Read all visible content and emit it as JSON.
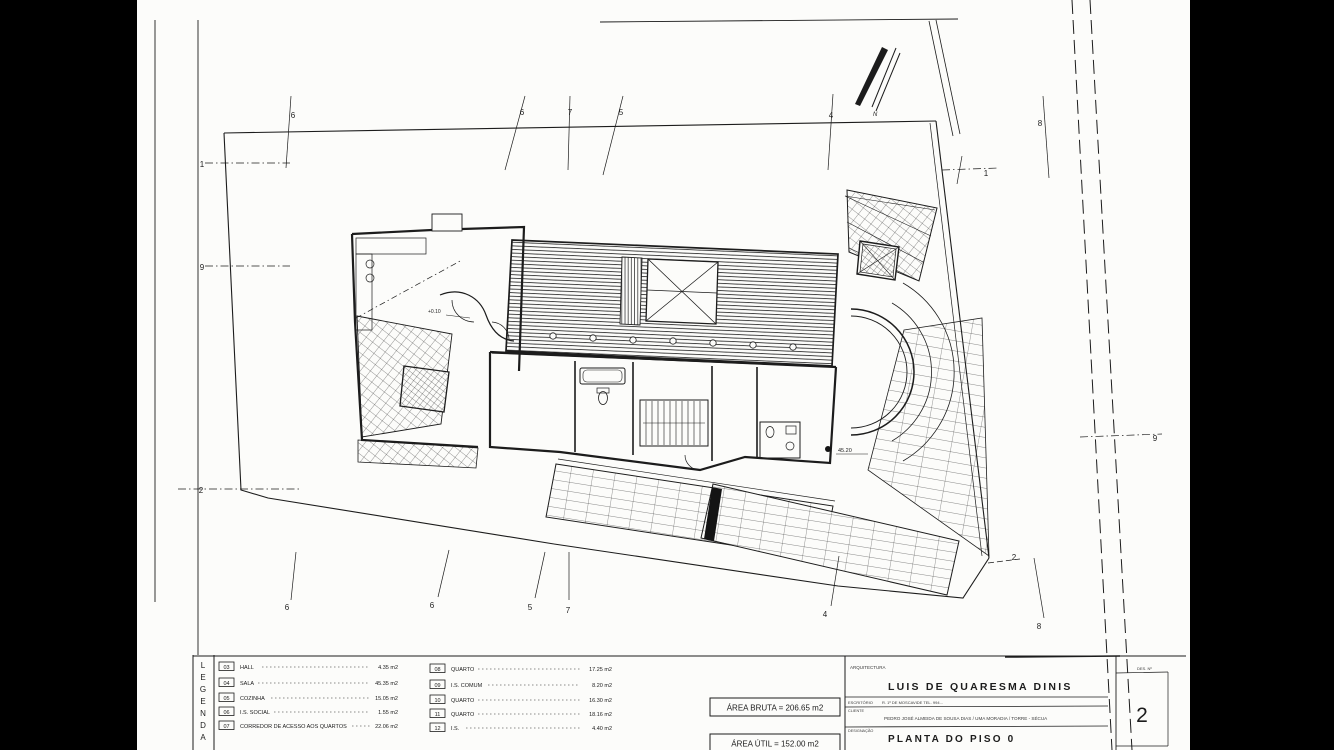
{
  "colors": {
    "background": "#000000",
    "paper": "#fcfcfa",
    "ink": "#1c1c1c"
  },
  "title_block": {
    "section_label": "ARQUITECTURA",
    "architect": "LUIS DE QUARESMA DINIS",
    "office_label": "ESCRITÓRIO",
    "office_info": "R. 1º DE  MOSCAVIDE   TEL. 994…",
    "client_label": "CLIENTE",
    "client_info": "PEDRO JOSÉ ALMEIDA DE SOUSA DIAS / UMA MORADIA / TORRE - SÉCUA",
    "designation_label": "DESIGNAÇÃO",
    "designation": "PLANTA DO PISO 0",
    "sheet_label": "DES. Nº",
    "sheet_number": "2"
  },
  "legend": {
    "title_letters": [
      "L",
      "E",
      "G",
      "E",
      "N",
      "D",
      "A"
    ],
    "left": [
      {
        "num": "03",
        "name": "HALL",
        "area": "4.35 m2"
      },
      {
        "num": "04",
        "name": "SALA",
        "area": "45.35 m2"
      },
      {
        "num": "05",
        "name": "COZINHA",
        "area": "15.05 m2"
      },
      {
        "num": "06",
        "name": "I.S. SOCIAL",
        "area": "1.55 m2"
      },
      {
        "num": "07",
        "name": "CORREDOR DE ACESSO AOS QUARTOS",
        "area": "22.06 m2"
      }
    ],
    "right": [
      {
        "num": "08",
        "name": "QUARTO",
        "area": "17.25 m2"
      },
      {
        "num": "09",
        "name": "I.S. COMUM",
        "area": "8.20 m2"
      },
      {
        "num": "10",
        "name": "QUARTO",
        "area": "16.30 m2"
      },
      {
        "num": "11",
        "name": "QUARTO",
        "area": "18.16 m2"
      },
      {
        "num": "12",
        "name": "I.S.",
        "area": "4.40 m2"
      }
    ]
  },
  "areas": {
    "bruta": "ÁREA BRUTA = 206.65 m2",
    "util": "ÁREA ÚTIL  = 152.00 m2"
  },
  "plan": {
    "north_label": "N",
    "grid_top": [
      "6",
      "6",
      "7",
      "5",
      "4",
      "8"
    ],
    "grid_bottom": [
      "6",
      "6",
      "5",
      "7",
      "4",
      "8"
    ],
    "grid_left": [
      "1",
      "9",
      "2"
    ],
    "grid_right": [
      "1",
      "9"
    ],
    "marker_2": "2",
    "levels": {
      "entry": "+0.10",
      "bench": "45.20"
    }
  }
}
